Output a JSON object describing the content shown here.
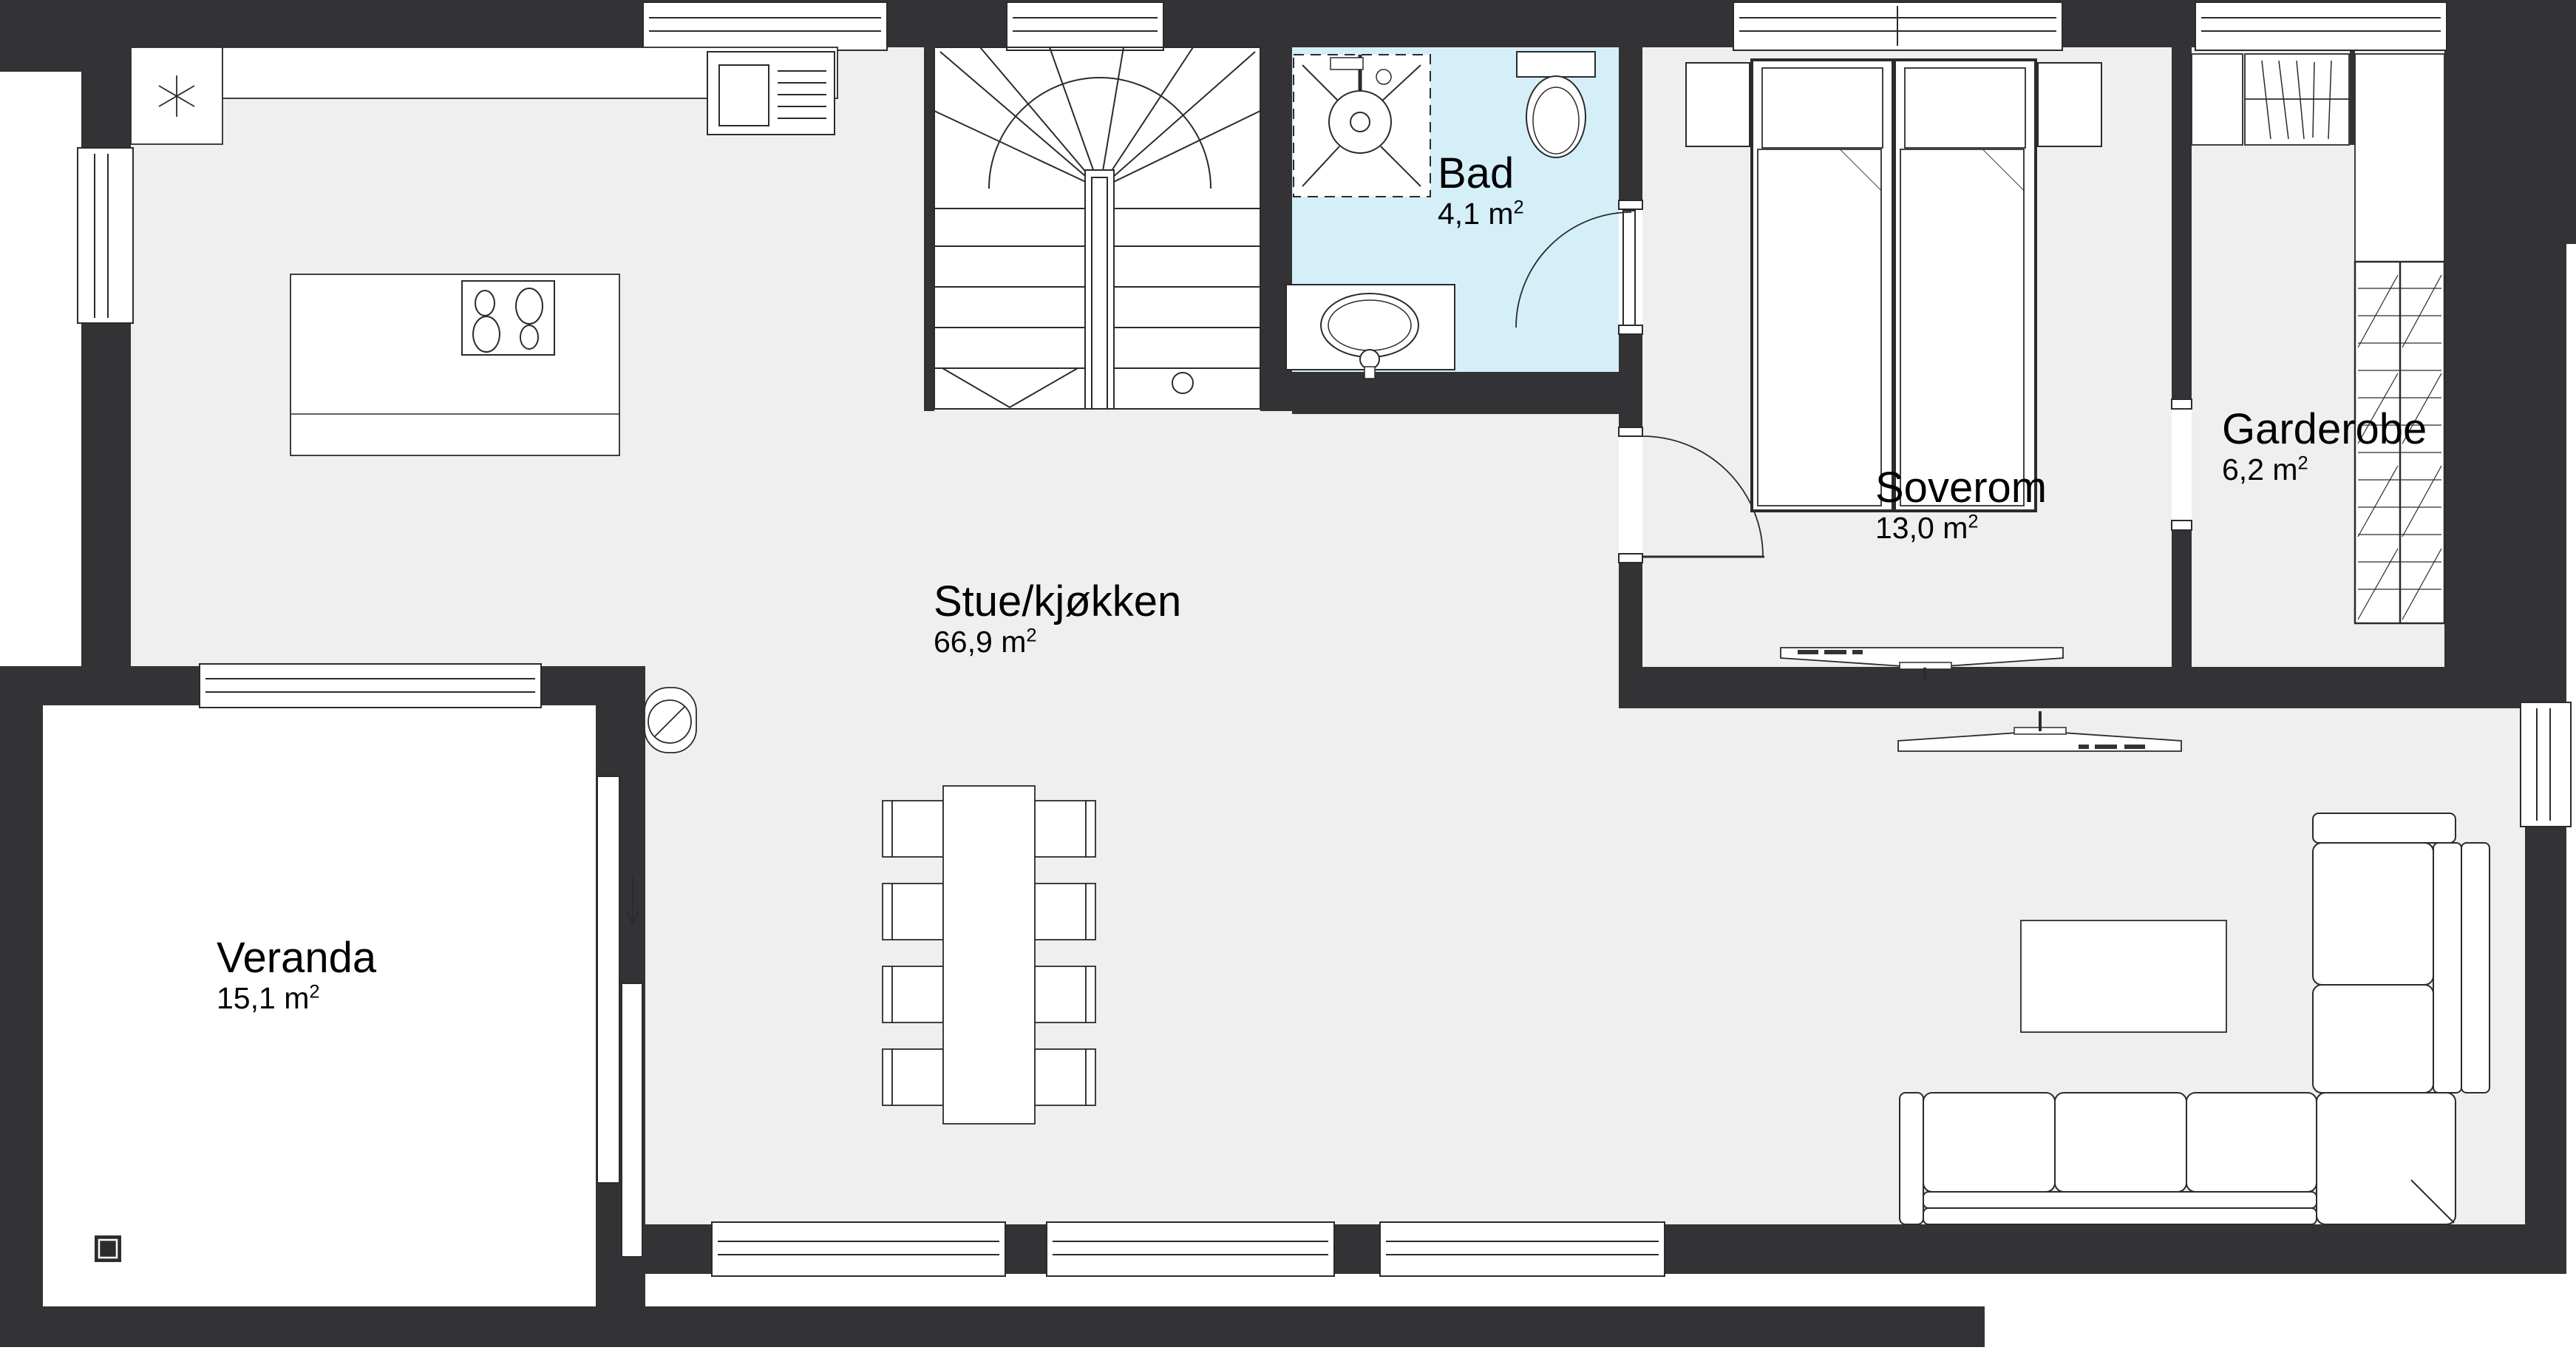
{
  "plan_title": "Floor plan",
  "rooms": [
    {
      "id": "stue",
      "name": "Stue/kjøkken",
      "area": "66,9 m",
      "area_sup": "2"
    },
    {
      "id": "bad",
      "name": "Bad",
      "area": "4,1 m",
      "area_sup": "2"
    },
    {
      "id": "soverom",
      "name": "Soverom",
      "area": "13,0 m",
      "area_sup": "2"
    },
    {
      "id": "garderobe",
      "name": "Garderobe",
      "area": "6,2 m",
      "area_sup": "2"
    },
    {
      "id": "veranda",
      "name": "Veranda",
      "area": "15,1 m",
      "area_sup": "2"
    }
  ],
  "colors": {
    "wall": "#333336",
    "floor": "#efefef",
    "bathroom": "#d5eff9",
    "line": "#2b2b2e"
  }
}
